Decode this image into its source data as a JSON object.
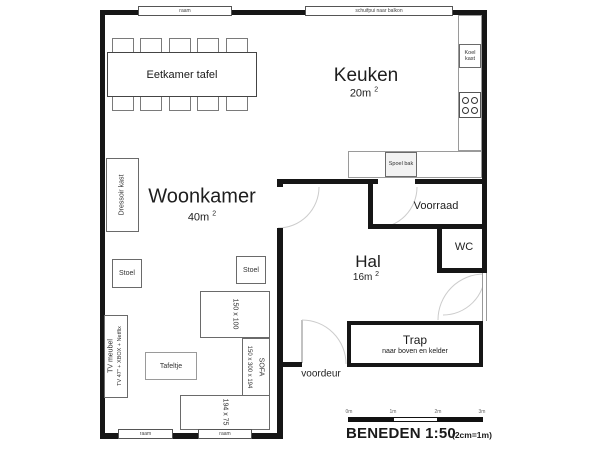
{
  "rooms": {
    "woonkamer": {
      "name": "Woonkamer",
      "area": "40m",
      "sup": "2"
    },
    "keuken": {
      "name": "Keuken",
      "area": "20m",
      "sup": "2"
    },
    "hal": {
      "name": "Hal",
      "area": "16m",
      "sup": "2"
    },
    "voorraad": {
      "name": "Voorraad"
    },
    "wc": {
      "name": "WC"
    },
    "trap": {
      "name": "Trap",
      "note": "naar boven en kelder"
    }
  },
  "openings": {
    "top_window": "raam",
    "balcony_slider": "schuifpui naar balkon",
    "bottom_window_left": "raam",
    "bottom_window_right": "raam",
    "front_door": "voordeur"
  },
  "furniture": {
    "dining_table": "Eetkamer tafel",
    "dressoir": "Dressoir kast",
    "chair_left": "Stoel",
    "chair_right": "Stoel",
    "coffee_table_dims": "150 x 100",
    "sofa": "SOFA",
    "sofa_dims": "150 x 300 x 194",
    "table_dims": "194 x 75",
    "side_table": "Tafeltje",
    "tv_line1": "TV meubel",
    "tv_line2": "TV 47\" + XBOX + Netflix",
    "fridge": "Koel kast",
    "sink": "Spoel bak"
  },
  "scale": {
    "ticks": [
      "0m",
      "1m",
      "2m",
      "3m"
    ],
    "title": "BENEDEN 1:50",
    "note": "(2cm=1m)"
  }
}
